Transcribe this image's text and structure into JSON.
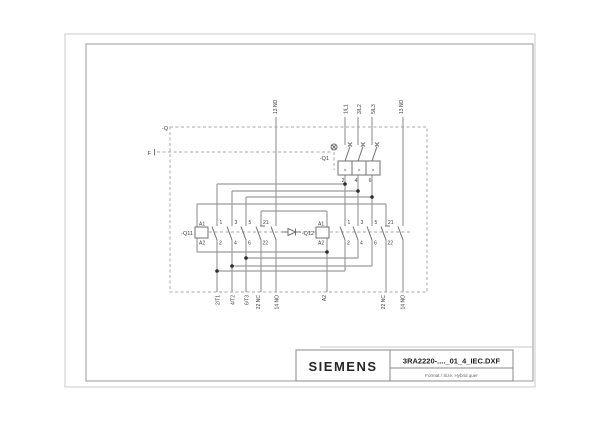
{
  "title_block": {
    "brand": "SIEMENS",
    "filename": "3RA2220-...._01_4_IEC.DXF",
    "format_line": "Format / Size: Hybrid quer"
  },
  "schematic": {
    "labels": [
      {
        "t": "-Q",
        "x": 168,
        "y": 130,
        "a": "end",
        "s": 5.5
      },
      {
        "t": "F",
        "x": 151,
        "y": 155,
        "a": "end",
        "s": 5.5
      },
      {
        "t": "-Q1",
        "x": 329,
        "y": 160,
        "a": "end",
        "s": 5.5
      },
      {
        "t": "-Q11",
        "x": 193,
        "y": 235,
        "a": "end",
        "s": 5.5
      },
      {
        "t": "-Q12",
        "x": 314,
        "y": 235,
        "a": "end",
        "s": 5.5
      },
      {
        "t": "A1",
        "x": 199,
        "y": 225.5,
        "s": 5
      },
      {
        "t": "A2",
        "x": 199,
        "y": 244.5,
        "s": 5
      },
      {
        "t": "A1",
        "x": 318,
        "y": 225.5,
        "s": 5
      },
      {
        "t": "A2",
        "x": 318,
        "y": 244.5,
        "s": 5
      },
      {
        "t": "1",
        "x": 219.5,
        "y": 224,
        "s": 5
      },
      {
        "t": "2",
        "x": 219,
        "y": 244.5,
        "s": 5
      },
      {
        "t": "3",
        "x": 234.5,
        "y": 224,
        "s": 5
      },
      {
        "t": "4",
        "x": 234,
        "y": 244.5,
        "s": 5
      },
      {
        "t": "5",
        "x": 248.5,
        "y": 224,
        "s": 5
      },
      {
        "t": "6",
        "x": 248,
        "y": 244.5,
        "s": 5
      },
      {
        "t": "21",
        "x": 263,
        "y": 224,
        "s": 5
      },
      {
        "t": "22",
        "x": 262.5,
        "y": 244.5,
        "s": 5
      },
      {
        "t": "1",
        "x": 347.5,
        "y": 224,
        "s": 5
      },
      {
        "t": "2",
        "x": 347,
        "y": 244.5,
        "s": 5
      },
      {
        "t": "3",
        "x": 360.5,
        "y": 224,
        "s": 5
      },
      {
        "t": "4",
        "x": 360,
        "y": 244.5,
        "s": 5
      },
      {
        "t": "5",
        "x": 374.5,
        "y": 224,
        "s": 5
      },
      {
        "t": "6",
        "x": 374,
        "y": 244.5,
        "s": 5
      },
      {
        "t": "21",
        "x": 388,
        "y": 224,
        "s": 5
      },
      {
        "t": "22",
        "x": 387.5,
        "y": 244.5,
        "s": 5
      },
      {
        "t": "2",
        "x": 343,
        "y": 182,
        "a": "middle",
        "s": 5
      },
      {
        "t": "4",
        "x": 356,
        "y": 182,
        "a": "middle",
        "s": 5
      },
      {
        "t": "6",
        "x": 370,
        "y": 182,
        "a": "middle",
        "s": 5
      },
      {
        "t": ">",
        "x": 345,
        "y": 171.5,
        "a": "middle",
        "s": 4.5
      },
      {
        "t": ">",
        "x": 359,
        "y": 171.5,
        "a": "middle",
        "s": 4.5
      },
      {
        "t": ">",
        "x": 373,
        "y": 171.5,
        "a": "middle",
        "s": 4.5
      },
      {
        "t": "13 NO",
        "x": 277,
        "y": 114,
        "r": -90,
        "s": 5
      },
      {
        "t": "1/L1",
        "x": 347.5,
        "y": 114,
        "r": -90,
        "s": 5
      },
      {
        "t": "3/L2",
        "x": 361,
        "y": 114,
        "r": -90,
        "s": 5
      },
      {
        "t": "5/L3",
        "x": 375,
        "y": 114,
        "r": -90,
        "s": 5
      },
      {
        "t": "13 NO",
        "x": 403,
        "y": 114,
        "r": -90,
        "s": 5
      },
      {
        "t": "2/T1",
        "x": 219.5,
        "y": 295,
        "r": -90,
        "a": "end",
        "s": 5
      },
      {
        "t": "4/T2",
        "x": 234.5,
        "y": 295,
        "r": -90,
        "a": "end",
        "s": 5
      },
      {
        "t": "6/T3",
        "x": 248.5,
        "y": 295,
        "r": -90,
        "a": "end",
        "s": 5
      },
      {
        "t": "22 NC",
        "x": 260,
        "y": 295,
        "r": -90,
        "a": "end",
        "s": 5
      },
      {
        "t": "14 NO",
        "x": 278.5,
        "y": 295,
        "r": -90,
        "a": "end",
        "s": 5
      },
      {
        "t": "A2",
        "x": 326,
        "y": 295,
        "r": -90,
        "a": "end",
        "s": 5
      },
      {
        "t": "22 NC",
        "x": 385,
        "y": 295,
        "r": -90,
        "a": "end",
        "s": 5
      },
      {
        "t": "14 NO",
        "x": 404.5,
        "y": 295,
        "r": -90,
        "a": "end",
        "s": 5
      }
    ]
  }
}
